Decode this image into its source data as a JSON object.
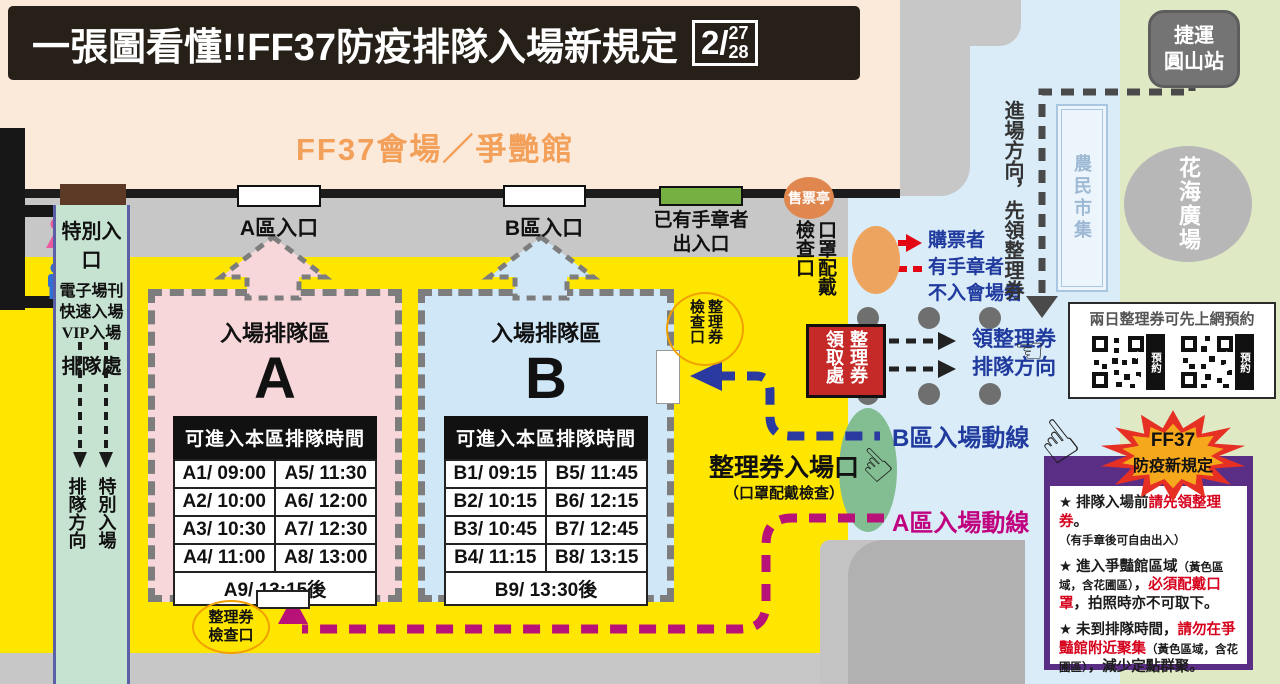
{
  "title": {
    "text": "一張圖看懂!!FF37防疫排隊入場新規定",
    "date_month": "2/",
    "date_day1": "27",
    "date_day2": "28"
  },
  "venue": {
    "hall_label": "FF37會場／爭艷館"
  },
  "map": {
    "mrt": [
      "捷運",
      "圓山站"
    ],
    "farmers_market": "農民市集",
    "flower_plaza": "花海廣場",
    "ticket_booth": "售票亭",
    "toilets": {
      "female": "女廁",
      "male": "男廁"
    },
    "special": {
      "title": "特別入口",
      "lines": [
        "電子場刊",
        "快速入場",
        "VIP入場"
      ],
      "queue_label": "排隊處",
      "dir_lines": [
        "特別入場",
        "排隊方向"
      ]
    },
    "entrance_a": "A區入口",
    "entrance_b": "B區入口",
    "stamp_exit": [
      "已有手章者",
      "出入口"
    ],
    "mask_check": [
      "口罩配戴",
      "檢查口"
    ],
    "approach_note": "進場方向，先領整理券",
    "visitors": [
      "購票者",
      "有手章者",
      "不入會場者"
    ],
    "office_lines": [
      "整理券",
      "領取處"
    ],
    "ticket_dir": [
      "領整理券",
      "排隊方向"
    ],
    "cp_b": [
      "整理券",
      "檢查口"
    ],
    "cp_a": [
      "整理券",
      "檢查口"
    ],
    "ticket_entrance": {
      "title": "整理券入場口",
      "subtitle": "（口罩配戴檢查）"
    },
    "route_b": "B區入場動線",
    "route_a": "A區入場動線"
  },
  "queue_a": {
    "zone_title": "入場排隊區",
    "zone_letter": "A",
    "table_header": "可進入本區排隊時間",
    "rows": [
      [
        "A1/ 09:00",
        "A5/ 11:30"
      ],
      [
        "A2/ 10:00",
        "A6/ 12:00"
      ],
      [
        "A3/ 10:30",
        "A7/ 12:30"
      ],
      [
        "A4/ 11:00",
        "A8/ 13:00"
      ],
      [
        "A9/ 13:15後"
      ]
    ]
  },
  "queue_b": {
    "zone_title": "入場排隊區",
    "zone_letter": "B",
    "table_header": "可進入本區排隊時間",
    "rows": [
      [
        "B1/ 09:15",
        "B5/ 11:45"
      ],
      [
        "B2/ 10:15",
        "B6/ 12:15"
      ],
      [
        "B3/ 10:45",
        "B7/ 12:45"
      ],
      [
        "B4/ 11:15",
        "B8/ 13:15"
      ],
      [
        "B9/ 13:30後"
      ]
    ]
  },
  "qr": {
    "title": "兩日整理券可先上網預約",
    "labels": [
      "預約2/27",
      "預約2/28"
    ]
  },
  "rules": {
    "burst": [
      "FF37",
      "防疫新規定"
    ],
    "items": [
      [
        {
          "t": "★ 排隊入場前"
        },
        {
          "t": "請先領整理券",
          "s": "red"
        },
        {
          "t": "。"
        },
        {
          "br": true
        },
        {
          "t": "（有手章後可自由出入）",
          "s": "small"
        }
      ],
      [
        {
          "t": "★ 進入爭豔館區域"
        },
        {
          "t": "（黃色區域，含花圃區）",
          "s": "small"
        },
        {
          "t": "，"
        },
        {
          "t": "必須配戴口罩",
          "s": "red"
        },
        {
          "t": "，拍照時亦不可取下。"
        }
      ],
      [
        {
          "t": "★ 未到排隊時間，"
        },
        {
          "t": "請勿在爭豔館附近聚集",
          "s": "red"
        },
        {
          "t": "（黃色區域，含花圃區）",
          "s": "small"
        },
        {
          "t": "，減少定點群聚。"
        }
      ]
    ]
  },
  "colors": {
    "yellow": "#ffe600",
    "peach": "#fbe9da",
    "blue_area": "#d9ecf8",
    "green_area": "#dfe9c4",
    "route_a": "#b81178",
    "route_b": "#2a3aa0",
    "alert_red": "#d6001c",
    "purple": "#5b2e86",
    "office_red": "#c62a28"
  }
}
